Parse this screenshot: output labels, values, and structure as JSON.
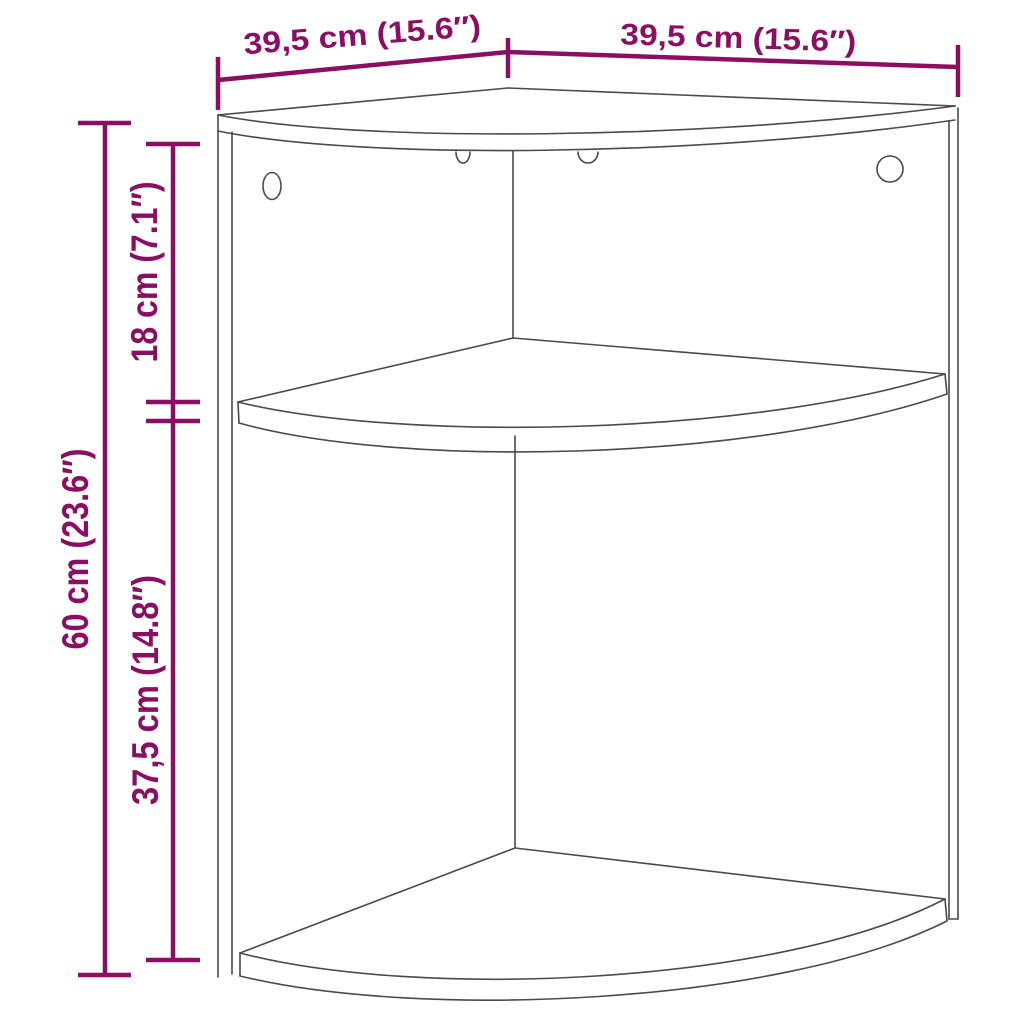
{
  "page": {
    "background": "#ffffff"
  },
  "diagram": {
    "type": "product-dimension-diagram",
    "product": "corner wall shelf cabinet with two quarter-circle shelves and mounting holes",
    "accent_color": "#8B0E63",
    "line_color": "#4A4A4A",
    "labels": {
      "width_left": "39,5 cm (15.6″)",
      "width_right": "39,5 cm (15.6″)",
      "height_total": "60 cm (23.6″)",
      "section_top": "18 cm (7.1″)",
      "section_bottom": "37,5 cm (14.8″)"
    },
    "values": {
      "width_left_cm": 39.5,
      "width_left_in": 15.6,
      "width_right_cm": 39.5,
      "width_right_in": 15.6,
      "height_total_cm": 60,
      "height_total_in": 23.6,
      "section_top_cm": 18,
      "section_top_in": 7.1,
      "section_bottom_cm": 37.5,
      "section_bottom_in": 14.8
    }
  }
}
